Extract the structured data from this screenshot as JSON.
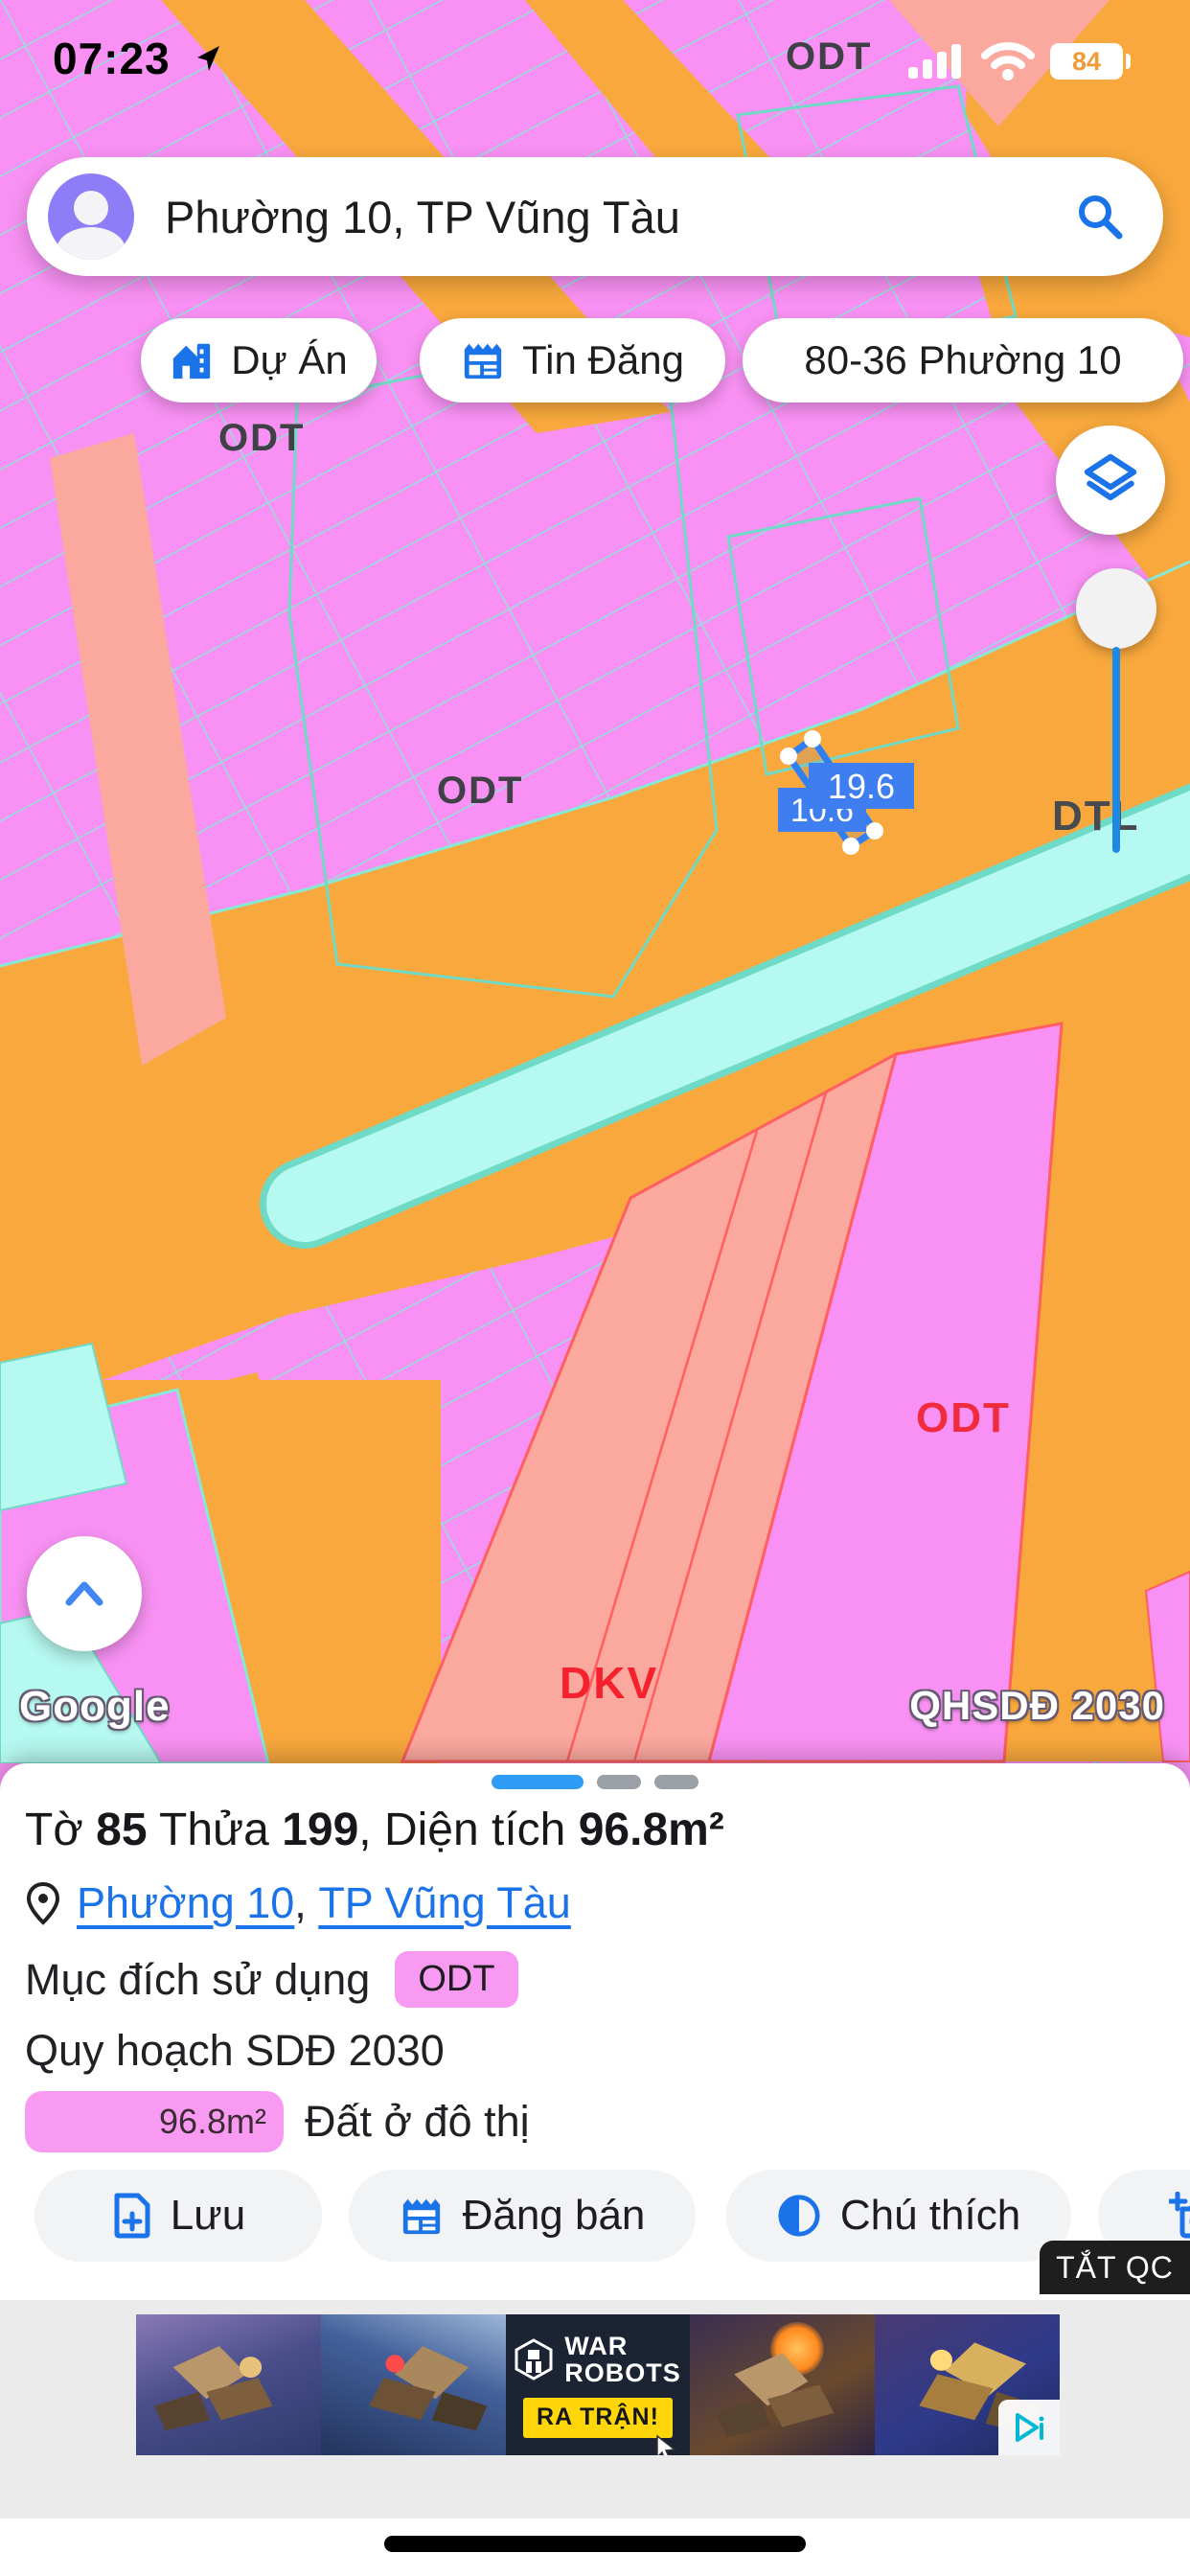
{
  "status_bar": {
    "time": "07:23",
    "battery": "84"
  },
  "search": {
    "query": "Phường 10, TP Vũng Tàu"
  },
  "chips": [
    {
      "label": "Dự Án"
    },
    {
      "label": "Tin Đăng"
    },
    {
      "label": "80-36 Phường 10"
    }
  ],
  "map": {
    "labels": {
      "odt_top": "ODT",
      "odt_left": "ODT",
      "odt_center": "ODT",
      "dtl": "DTL",
      "odt_red": "ODT",
      "dkv": "DKV"
    },
    "parcel": {
      "dim_front": "19.6",
      "dim_back": "10.6"
    },
    "watermark_left": "Google",
    "watermark_right": "QHSDĐ 2030",
    "colors": {
      "residential_pink": "#f891f3",
      "salmon": "#fba89f",
      "road_orange": "#f8a83d",
      "water_cyan": "#b6f9f0",
      "parcel_line": "#86e9d6",
      "selection_blue": "#2f7ff2",
      "red_zone_line": "#ff5f5f"
    }
  },
  "sheet": {
    "title": {
      "t0": "Tờ ",
      "b0": "85",
      "t1": " Thửa ",
      "b1": "199",
      "t2": ", Diện tích ",
      "b2": "96.8m²"
    },
    "location": {
      "ward": "Phường 10",
      "separator": ", ",
      "city": "TP Vũng Tàu"
    },
    "purpose_label": "Mục đích sử dụng",
    "purpose_value": "ODT",
    "plan_label": "Quy hoạch SDĐ 2030",
    "legend": {
      "area": "96.8m²",
      "name": "Đất ở đô thị"
    },
    "actions": [
      {
        "label": "Lưu"
      },
      {
        "label": "Đăng bán"
      },
      {
        "label": "Chú thích"
      }
    ],
    "ad_dismiss": "TẮT QC"
  },
  "ad": {
    "line1": "WAR",
    "line2": "ROBOTS",
    "cta": "RA TRẬN!"
  }
}
